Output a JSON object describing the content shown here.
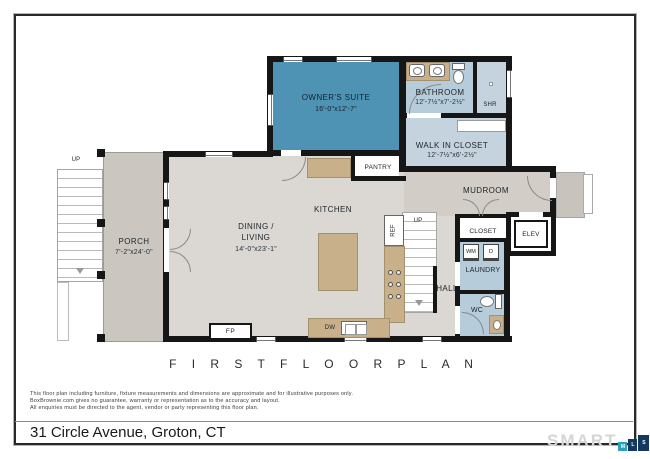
{
  "page": {
    "plan_title": "F I R S T   F L O O R   P L A N",
    "address": "31 Circle Avenue, Groton, CT",
    "disclaimer": {
      "line1": "This floor plan including furniture, fixture measurements and dimensions are approximate and for illustrative purposes only.",
      "line2": "BoxBrownie.com gives no guarantee, warranty or representation as to the accuracy and layout.",
      "line3": "All enquiries must be directed to the agent, vendor or party representing this floor plan."
    },
    "logo": {
      "brand": "SMART",
      "blocks": [
        "M",
        "L",
        "S"
      ]
    }
  },
  "rooms": {
    "owners_suite": {
      "label": "OWNER'S SUITE",
      "dims": "16'-0\"x12'-7\""
    },
    "bathroom": {
      "label": "BATHROOM",
      "dims": "12'-7½\"x7'-2½\""
    },
    "shower": {
      "label": "SHR"
    },
    "walk_in_closet": {
      "label": "WALK IN CLOSET",
      "dims": "12'-7½\"x6'-2½\""
    },
    "pantry": {
      "label": "PANTRY"
    },
    "mudroom": {
      "label": "MUDROOM"
    },
    "kitchen": {
      "label": "KITCHEN"
    },
    "dining_living": {
      "line1": "DINING /",
      "line2": "LIVING",
      "dims": "14'-0\"x23'-1\""
    },
    "porch": {
      "label": "PORCH",
      "dims": "7'-2\"x24'-0\""
    },
    "hall": {
      "label": "HALL"
    },
    "closet": {
      "label": "CLOSET"
    },
    "laundry": {
      "label": "LAUNDRY"
    },
    "elevator": {
      "label": "ELEV"
    },
    "wc": {
      "label": "WC"
    }
  },
  "fixtures": {
    "fireplace": "FP",
    "dishwasher": "DW",
    "refrigerator": "REF",
    "washer": "WM",
    "dryer": "D",
    "stairs_exterior_up": "UP",
    "stairs_interior_up": "UP"
  },
  "colors": {
    "c_suite": "#4E92B4",
    "c_blue": "#B6CCDB",
    "c_blue_light": "#C5D3DF",
    "c_floor": "#DBD7D2",
    "c_mud": "#D2CEC7",
    "c_porch": "#CBC7C0",
    "c_stoop": "#C8C4BD",
    "c_tan": "#C7B08A",
    "c_wall": "#161616",
    "c_logo_gray": "#D5D5D5",
    "c_logo_teal": "#2B9FBC",
    "c_logo_navy": "#14395E"
  }
}
